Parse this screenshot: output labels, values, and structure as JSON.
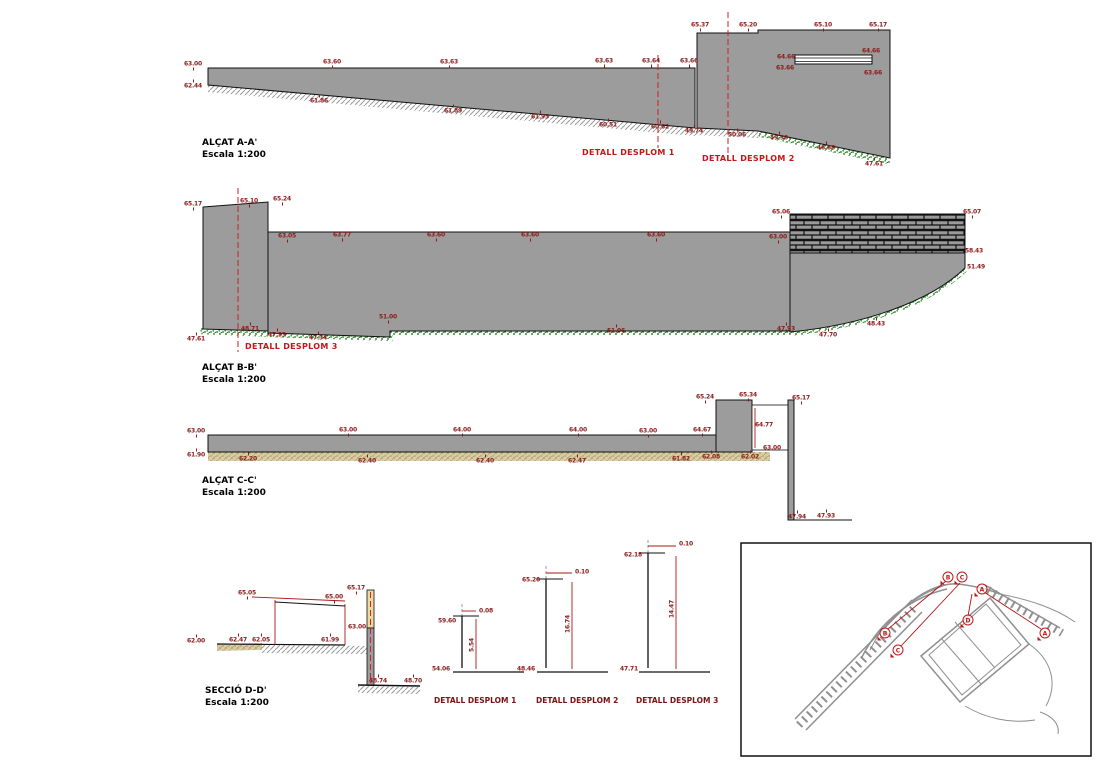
{
  "colors": {
    "wall_gray": "#9c9c9c",
    "masonry_gray": "#9a9a9a",
    "hatch_gray": "#999999",
    "vegetation_green": "#0b7a0b",
    "ground_tan": "#b5a36a",
    "section_fill_tan": "#ecd9a4",
    "dim_red": "#8b1a1a",
    "callout_red": "#c21717",
    "cut_line_red": "#cc2222",
    "line_black": "#111111",
    "plan_gray": "#8f8f8f"
  },
  "sections": [
    {
      "id": "elev-a",
      "title": "ALÇAT A-A'",
      "scale": "Escala 1:200"
    },
    {
      "id": "elev-b",
      "title": "ALÇAT B-B'",
      "scale": "Escala 1:200"
    },
    {
      "id": "elev-c",
      "title": "ALÇAT C-C'",
      "scale": "Escala 1:200"
    },
    {
      "id": "secc-d",
      "title": "SECCIÓ D-D'",
      "scale": "Escala 1:200"
    }
  ],
  "detail_callouts": [
    {
      "label": "DETALL DESPLOM 1"
    },
    {
      "label": "DETALL DESPLOM 2"
    },
    {
      "label": "DETALL DESPLOM 3"
    }
  ],
  "details": [
    {
      "label": "DETALL DESPLOM 1",
      "top_offset": "0.08",
      "top_level": "59.60",
      "bottom_level": "54.06",
      "height": "5.54"
    },
    {
      "label": "DETALL DESPLOM 2",
      "top_offset": "0.10",
      "top_level": "65.20",
      "bottom_level": "48.46",
      "height": "16.74"
    },
    {
      "label": "DETALL DESPLOM 3",
      "top_offset": "0.10",
      "top_level": "62.18",
      "bottom_level": "47.71",
      "height": "14.47"
    }
  ],
  "site_plan": {
    "markers": [
      {
        "letter": "B",
        "x": 948,
        "y": 577
      },
      {
        "letter": "C",
        "x": 962,
        "y": 577
      },
      {
        "letter": "A",
        "x": 982,
        "y": 589
      },
      {
        "letter": "B",
        "x": 885,
        "y": 633
      },
      {
        "letter": "C",
        "x": 898,
        "y": 650
      },
      {
        "letter": "D",
        "x": 968,
        "y": 620
      },
      {
        "letter": "A",
        "x": 1045,
        "y": 633
      }
    ]
  },
  "annotations": [
    {
      "x": 193,
      "y": 64,
      "t": "63.00",
      "k": "d"
    },
    {
      "x": 193,
      "y": 86,
      "t": "62.44",
      "k": "b"
    },
    {
      "x": 332,
      "y": 62,
      "t": "63.60",
      "k": "d"
    },
    {
      "x": 449,
      "y": 62,
      "t": "63.63",
      "k": "d"
    },
    {
      "x": 604,
      "y": 61,
      "t": "63.63",
      "k": "d"
    },
    {
      "x": 651,
      "y": 61,
      "t": "63.64",
      "k": "d"
    },
    {
      "x": 689,
      "y": 61,
      "t": "63.66",
      "k": "d"
    },
    {
      "x": 319,
      "y": 101,
      "t": "61.86",
      "k": "b"
    },
    {
      "x": 453,
      "y": 111,
      "t": "61.89",
      "k": "b"
    },
    {
      "x": 540,
      "y": 117,
      "t": "61.95",
      "k": "b"
    },
    {
      "x": 608,
      "y": 125,
      "t": "60.51",
      "k": "b"
    },
    {
      "x": 660,
      "y": 127,
      "t": "60.62",
      "k": "b"
    },
    {
      "x": 694,
      "y": 131,
      "t": "49.74",
      "k": "b"
    },
    {
      "x": 737,
      "y": 135,
      "t": "50.06",
      "k": "b"
    },
    {
      "x": 779,
      "y": 138,
      "t": "49.30",
      "k": "b"
    },
    {
      "x": 826,
      "y": 148,
      "t": "48.88",
      "k": "b"
    },
    {
      "x": 874,
      "y": 164,
      "t": "47.61",
      "k": "b"
    },
    {
      "x": 700,
      "y": 25,
      "t": "65.37",
      "k": "d"
    },
    {
      "x": 748,
      "y": 25,
      "t": "65.20",
      "k": "d"
    },
    {
      "x": 823,
      "y": 25,
      "t": "65.10",
      "k": "d"
    },
    {
      "x": 878,
      "y": 25,
      "t": "65.17",
      "k": "d"
    },
    {
      "x": 786,
      "y": 57,
      "t": "64.66",
      "k": "n"
    },
    {
      "x": 785,
      "y": 68,
      "t": "63.66",
      "k": "n"
    },
    {
      "x": 871,
      "y": 51,
      "t": "64.66",
      "k": "n"
    },
    {
      "x": 873,
      "y": 73,
      "t": "63.66",
      "k": "n"
    },
    {
      "x": 193,
      "y": 204,
      "t": "65.17",
      "k": "d"
    },
    {
      "x": 249,
      "y": 201,
      "t": "65.10",
      "k": "d"
    },
    {
      "x": 282,
      "y": 199,
      "t": "65.24",
      "k": "d"
    },
    {
      "x": 287,
      "y": 236,
      "t": "63.05",
      "k": "d"
    },
    {
      "x": 342,
      "y": 235,
      "t": "63.77",
      "k": "d"
    },
    {
      "x": 436,
      "y": 235,
      "t": "63.60",
      "k": "d"
    },
    {
      "x": 530,
      "y": 235,
      "t": "63.60",
      "k": "d"
    },
    {
      "x": 656,
      "y": 235,
      "t": "63.60",
      "k": "d"
    },
    {
      "x": 778,
      "y": 237,
      "t": "63.00",
      "k": "d"
    },
    {
      "x": 196,
      "y": 339,
      "t": "47.61",
      "k": "b"
    },
    {
      "x": 250,
      "y": 329,
      "t": "48.71",
      "k": "b"
    },
    {
      "x": 277,
      "y": 335,
      "t": "47.99",
      "k": "b"
    },
    {
      "x": 318,
      "y": 338,
      "t": "47.34",
      "k": "b"
    },
    {
      "x": 388,
      "y": 317,
      "t": "51.00",
      "k": "d"
    },
    {
      "x": 616,
      "y": 331,
      "t": "51.06",
      "k": "b"
    },
    {
      "x": 786,
      "y": 329,
      "t": "47.93",
      "k": "b"
    },
    {
      "x": 828,
      "y": 335,
      "t": "47.70",
      "k": "b"
    },
    {
      "x": 876,
      "y": 324,
      "t": "48.43",
      "k": "b"
    },
    {
      "x": 781,
      "y": 212,
      "t": "65.06",
      "k": "d"
    },
    {
      "x": 972,
      "y": 212,
      "t": "65.07",
      "k": "d"
    },
    {
      "x": 974,
      "y": 251,
      "t": "58.43",
      "k": "n"
    },
    {
      "x": 976,
      "y": 267,
      "t": "51.49",
      "k": "n"
    },
    {
      "x": 196,
      "y": 431,
      "t": "63.00",
      "k": "d"
    },
    {
      "x": 348,
      "y": 430,
      "t": "63.00",
      "k": "d"
    },
    {
      "x": 462,
      "y": 430,
      "t": "64.00",
      "k": "d"
    },
    {
      "x": 578,
      "y": 430,
      "t": "64.00",
      "k": "d"
    },
    {
      "x": 648,
      "y": 431,
      "t": "63.00",
      "k": "d"
    },
    {
      "x": 702,
      "y": 430,
      "t": "64.67",
      "k": "d"
    },
    {
      "x": 196,
      "y": 455,
      "t": "61.90",
      "k": "b"
    },
    {
      "x": 248,
      "y": 459,
      "t": "62.20",
      "k": "b"
    },
    {
      "x": 367,
      "y": 461,
      "t": "62.40",
      "k": "b"
    },
    {
      "x": 485,
      "y": 461,
      "t": "62.40",
      "k": "b"
    },
    {
      "x": 577,
      "y": 461,
      "t": "62.47",
      "k": "b"
    },
    {
      "x": 681,
      "y": 459,
      "t": "61.82",
      "k": "b"
    },
    {
      "x": 711,
      "y": 457,
      "t": "62.08",
      "k": "b"
    },
    {
      "x": 750,
      "y": 457,
      "t": "62.02",
      "k": "b"
    },
    {
      "x": 705,
      "y": 397,
      "t": "65.24",
      "k": "d"
    },
    {
      "x": 748,
      "y": 395,
      "t": "65.34",
      "k": "d"
    },
    {
      "x": 764,
      "y": 425,
      "t": "64.77",
      "k": "n"
    },
    {
      "x": 801,
      "y": 398,
      "t": "65.17",
      "k": "d"
    },
    {
      "x": 772,
      "y": 448,
      "t": "63.00",
      "k": "n"
    },
    {
      "x": 797,
      "y": 517,
      "t": "47.94",
      "k": "b"
    },
    {
      "x": 826,
      "y": 516,
      "t": "47.93",
      "k": "b"
    },
    {
      "x": 196,
      "y": 641,
      "t": "62.00",
      "k": "b"
    },
    {
      "x": 238,
      "y": 640,
      "t": "62.47",
      "k": "b"
    },
    {
      "x": 261,
      "y": 640,
      "t": "62.05",
      "k": "b"
    },
    {
      "x": 330,
      "y": 640,
      "t": "61.99",
      "k": "b"
    },
    {
      "x": 247,
      "y": 593,
      "t": "65.05",
      "k": "d"
    },
    {
      "x": 334,
      "y": 597,
      "t": "65.00",
      "k": "d"
    },
    {
      "x": 356,
      "y": 588,
      "t": "65.17",
      "k": "d"
    },
    {
      "x": 357,
      "y": 627,
      "t": "63.00",
      "k": "n"
    },
    {
      "x": 378,
      "y": 681,
      "t": "48.74",
      "k": "b"
    },
    {
      "x": 413,
      "y": 681,
      "t": "48.70",
      "k": "b"
    },
    {
      "x": 447,
      "y": 621,
      "t": "59.60",
      "k": "n"
    },
    {
      "x": 441,
      "y": 669,
      "t": "54.06",
      "k": "n"
    },
    {
      "x": 472,
      "y": 645,
      "t": "5.54",
      "k": "v"
    },
    {
      "x": 486,
      "y": 611,
      "t": "0.08",
      "k": "n"
    },
    {
      "x": 531,
      "y": 580,
      "t": "65.20",
      "k": "n"
    },
    {
      "x": 526,
      "y": 669,
      "t": "48.46",
      "k": "n"
    },
    {
      "x": 568,
      "y": 624,
      "t": "16.74",
      "k": "v"
    },
    {
      "x": 582,
      "y": 572,
      "t": "0.10",
      "k": "n"
    },
    {
      "x": 633,
      "y": 555,
      "t": "62.18",
      "k": "n"
    },
    {
      "x": 629,
      "y": 669,
      "t": "47.71",
      "k": "n"
    },
    {
      "x": 672,
      "y": 609,
      "t": "14.47",
      "k": "v"
    },
    {
      "x": 686,
      "y": 544,
      "t": "0.10",
      "k": "n"
    }
  ]
}
